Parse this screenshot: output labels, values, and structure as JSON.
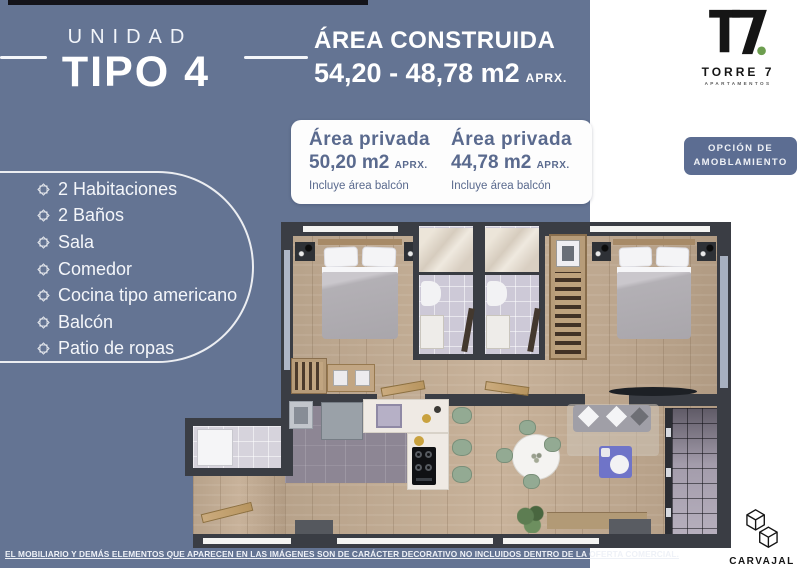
{
  "colors": {
    "background_blue": "#647493",
    "card_text_blue": "#5a6a8e",
    "button_blue": "#5c6d92",
    "wall_dark": "#3a3d44",
    "wood_floor": "#bba68e",
    "logo_green_dot": "#6d9e4f",
    "furniture_blue_table": "#6f74c8",
    "chair_green": "#93aa93"
  },
  "header": {
    "unit_label": "UNIDAD",
    "unit_type": "TIPO 4",
    "area_built_title": "ÁREA CONSTRUIDA",
    "area_built_value": "54,20 - 48,78 m2",
    "area_built_aprx": "APRX."
  },
  "private_areas": [
    {
      "title": "Área privada",
      "value": "50,20 m2",
      "aprx": "APRX.",
      "note": "Incluye área balcón"
    },
    {
      "title": "Área privada",
      "value": "44,78 m2",
      "aprx": "APRX.",
      "note": "Incluye área balcón"
    }
  ],
  "brand": {
    "name": "TORRE 7",
    "sub": "APARTAMENTOS"
  },
  "furnish_button": {
    "line1": "OPCIÓN DE",
    "line2": "AMOBLAMIENTO"
  },
  "features": {
    "items": [
      {
        "label": "2 Habitaciones"
      },
      {
        "label": "2 Baños"
      },
      {
        "label": "Sala"
      },
      {
        "label": "Comedor"
      },
      {
        "label": "Cocina tipo americano"
      },
      {
        "label": "Balcón"
      },
      {
        "label": "Patio de ropas"
      }
    ]
  },
  "disclaimer": {
    "text": "EL MOBILIARIO Y DEMÁS ELEMENTOS QUE APARECEN EN LAS IMÁGENES SON DE CARÁCTER DECORATIVO NO INCLUIDOS DENTRO DE LA OFERTA COMERCIAL."
  },
  "footer_brand": {
    "name": "CARVAJAL",
    "sub": "CONSTRUCTORES"
  }
}
